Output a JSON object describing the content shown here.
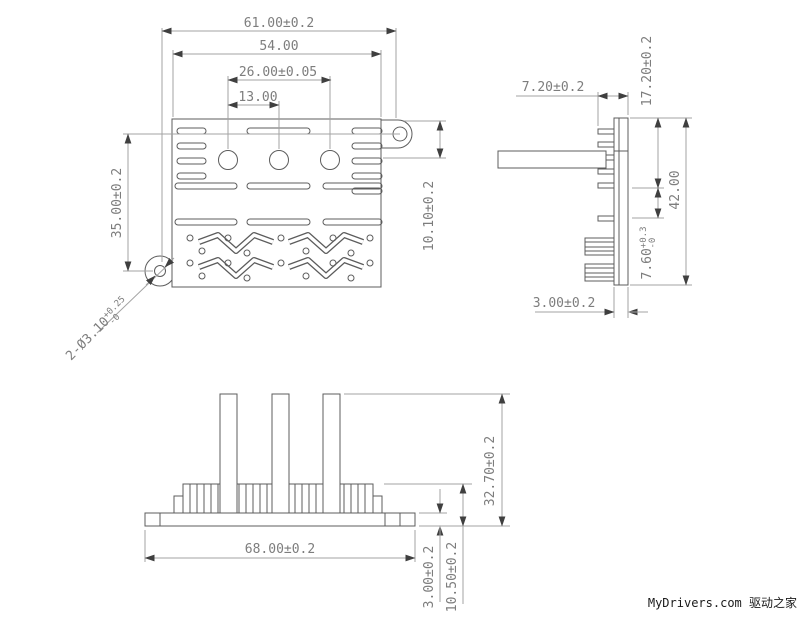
{
  "drawing": {
    "top_view": {
      "dim_overall_width": "61.00±0.2",
      "dim_body_width": "54.00",
      "dim_hole_span": "26.00±0.05",
      "dim_hole_pitch": "13.00",
      "dim_height": "35.00±0.2",
      "dim_tab_offset": "10.10±0.2",
      "hole_callout": {
        "prefix": "2-Ø3.10",
        "tol_upper": "+0.25",
        "tol_lower": "-0"
      }
    },
    "side_view": {
      "dim_fin_depth": "7.20±0.2",
      "dim_tab_drop": "17.20±0.2",
      "dim_height": "42.00",
      "fin_span": {
        "value": "7.60",
        "tol_upper": "+0.3",
        "tol_lower": "-0"
      },
      "dim_plate_thickness": "3.00±0.2"
    },
    "front_view": {
      "dim_width": "68.00±0.2",
      "dim_base_thickness": "3.00±0.2",
      "dim_base_fin_height": "10.50±0.2",
      "dim_total_height": "32.70±0.2"
    },
    "watermark": "MyDrivers.com 驱动之家",
    "colors": {
      "background": "#ffffff",
      "outline": "#5c5c5c",
      "dimension_line": "#a3a3a3",
      "dimension_text": "#7d7d7d",
      "arrow": "#3f3f3f",
      "watermark_text": "#1a1a1a"
    }
  }
}
